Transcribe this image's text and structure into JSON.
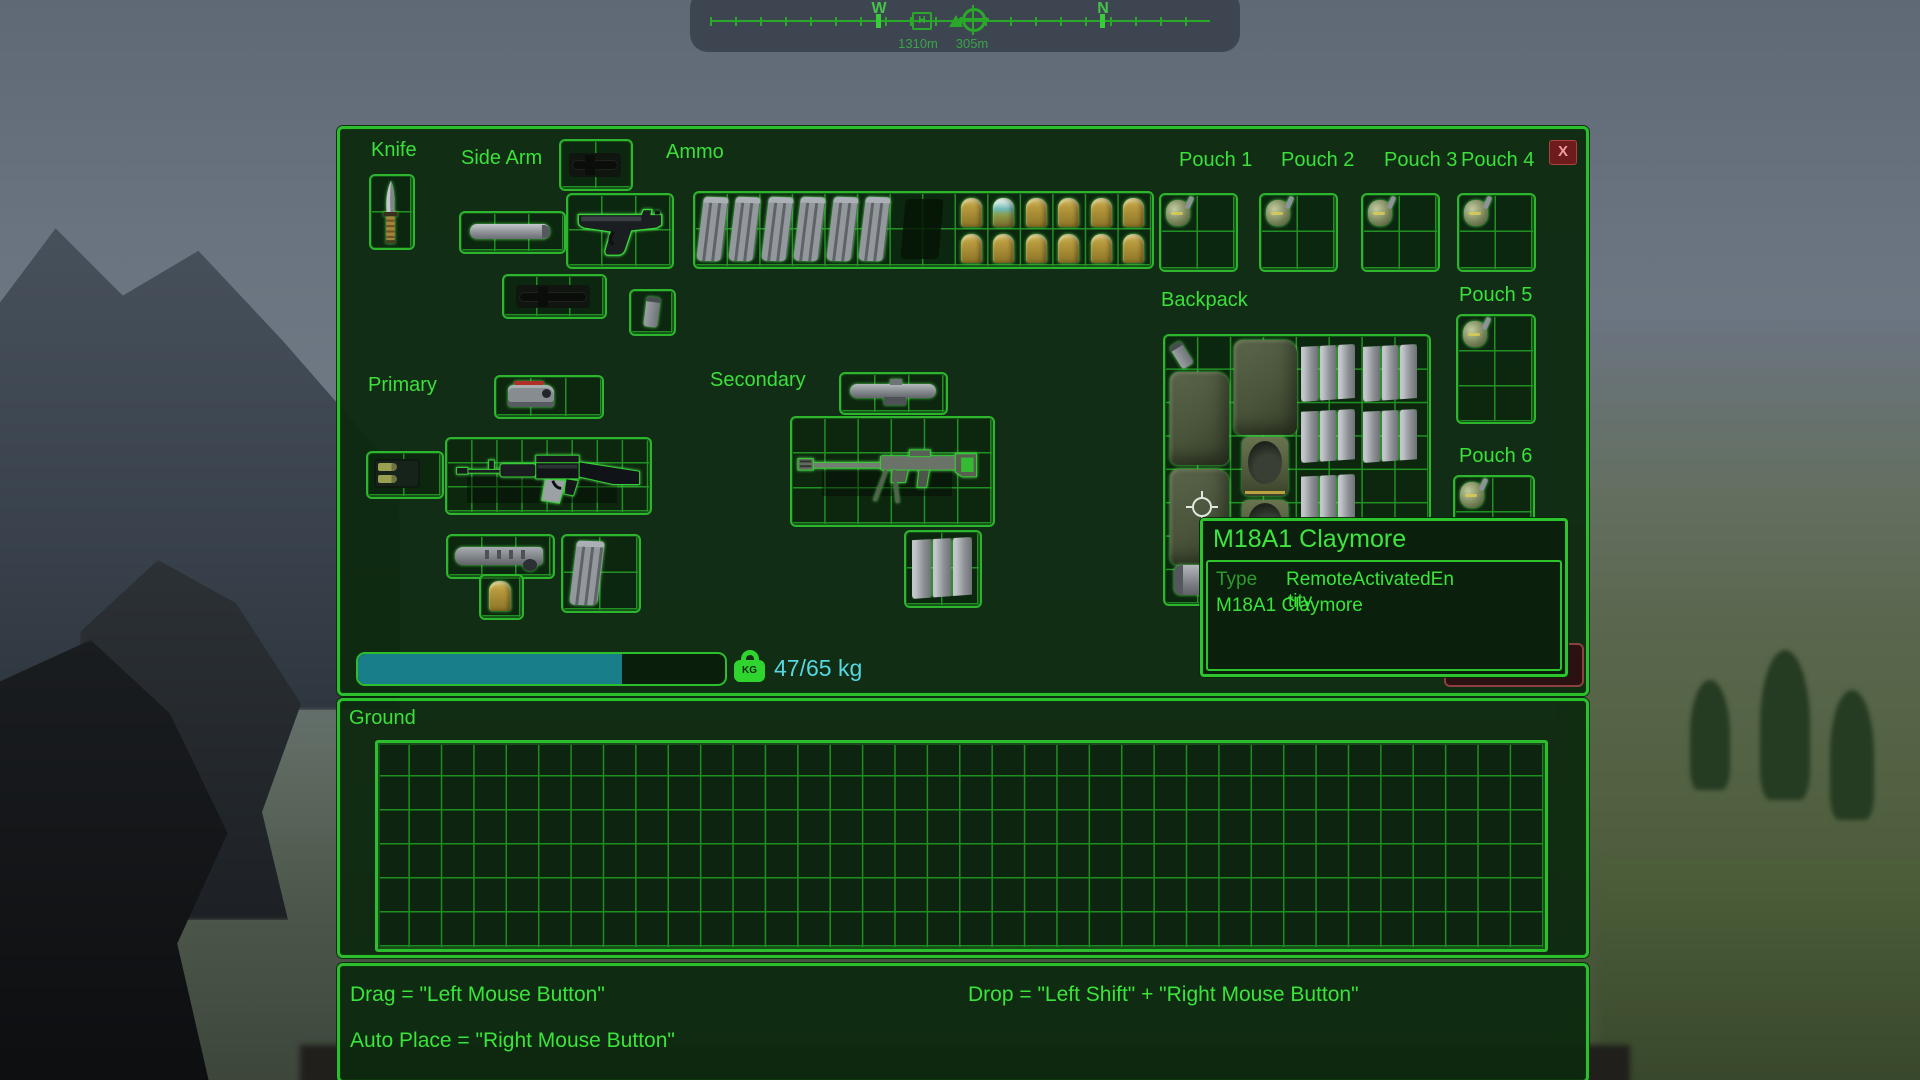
{
  "compass": {
    "west": "W",
    "north": "N",
    "h_marker": "H",
    "distance_1": "1310m",
    "distance_2": "305m"
  },
  "inventory": {
    "sections": {
      "knife": "Knife",
      "side_arm": "Side Arm",
      "ammo": "Ammo",
      "primary": "Primary",
      "secondary": "Secondary",
      "backpack": "Backpack"
    },
    "pouches": [
      "Pouch 1",
      "Pouch 2",
      "Pouch 3",
      "Pouch 4",
      "Pouch 5",
      "Pouch 6"
    ],
    "close_label": "X",
    "weight": {
      "text": "47/65 kg",
      "icon_label": "KG",
      "fill_percent": 72,
      "fill_color": "#187f8a",
      "text_color": "#55d8e2"
    },
    "drop_all_label": "Drop All",
    "items": {
      "hovered_item": "M18A1 Claymore",
      "ammo_grid": {
        "rifle_magazines": 6,
        "grenades_40mm": 11,
        "smoke_rounds_40mm": 1
      },
      "pouch_contents": "frag-grenade"
    }
  },
  "tooltip": {
    "title": "M18A1 Claymore",
    "type_label": "Type",
    "type_value_wrap": [
      "RemoteActivatedEn",
      "tity"
    ],
    "item_name": "M18A1 Claymore"
  },
  "ground": {
    "label": "Ground"
  },
  "help": {
    "drag": "Drag = \"Left Mouse Button\"",
    "drop": "Drop = \"Left Shift\" + \"Right Mouse Button\"",
    "auto_place": "Auto Place = \"Right Mouse Button\""
  },
  "colors": {
    "accent_green": "#2dbe2d",
    "bright_green": "#3ae43a",
    "panel_bg": "#0d290f",
    "weight_fill": "#187f8a",
    "close_red": "#6e1b1b"
  }
}
